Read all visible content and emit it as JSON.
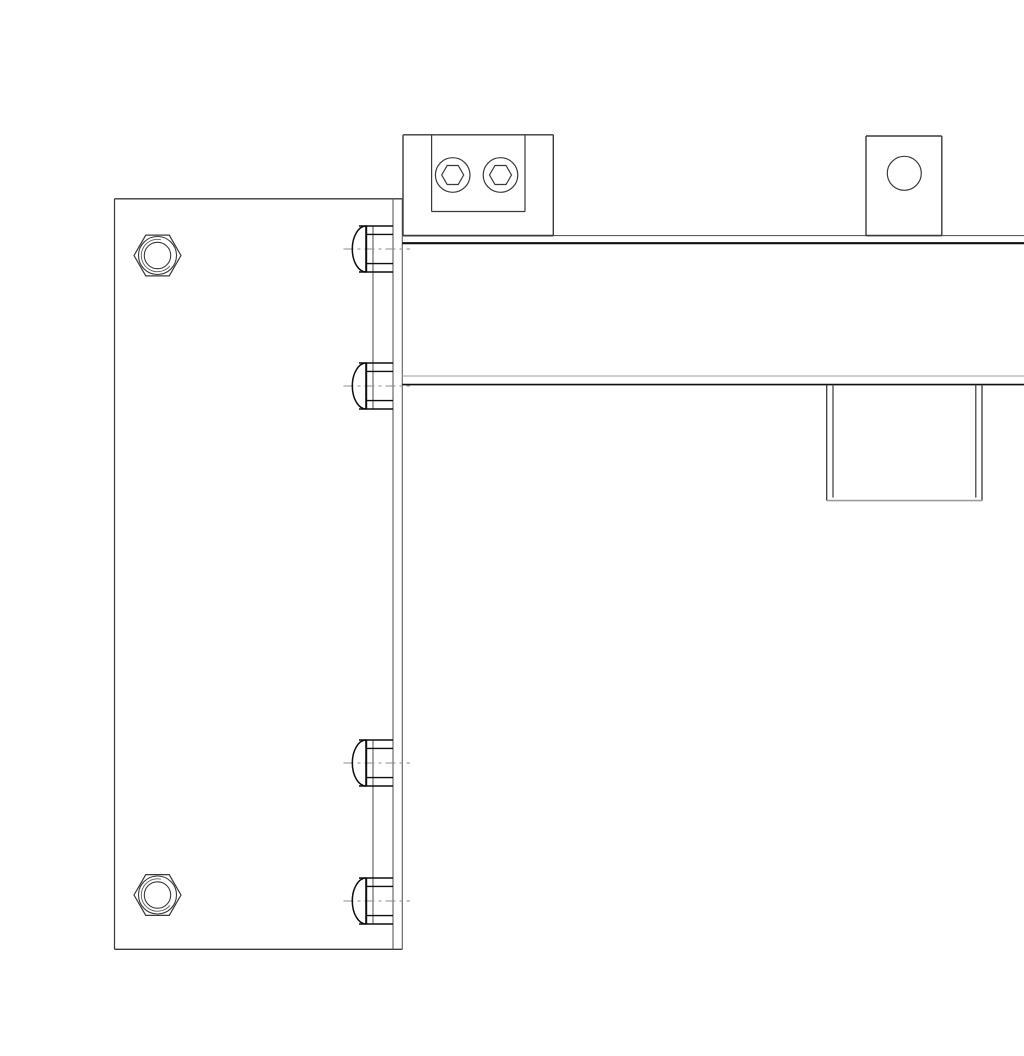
{
  "drawing": {
    "kind": "technical-line-drawing",
    "view": "orthographic-side-view",
    "subject": "L-shaped bracket assembly: tall mounting plate with two hex nuts and two pairs of button-head fasteners, horizontal box beam carrying a clamp bracket with two nut holes, a lifting tab with a round hole, and a hanging end block",
    "background": "#ffffff",
    "canvas": {
      "width": 1024,
      "height": 1024
    },
    "colors": {
      "outline": "#3a3a3a",
      "bold": "#0e0e0e",
      "medium": "#5c5c5c",
      "light": "#9c9c9c",
      "centerline": "#8d8d8d"
    },
    "centerline_dash": "10 4 3 4",
    "plate": {
      "x1": 74.5,
      "y1": 182.8,
      "x2": 353,
      "y2": 933.3,
      "back_edge_x": 362.3
    },
    "plate_nuts": {
      "centers": [
        [
          117.5,
          239.5
        ],
        [
          117.5,
          879
        ]
      ],
      "hex_r": 23.5,
      "face_r": 19,
      "bore_r": 13.2,
      "thread_r": 16.2,
      "thread_gap_start_deg": 40,
      "thread_gap_end_deg": -78
    },
    "bolts": {
      "pairs": [
        [
          233,
          370
        ],
        [
          747,
          885
        ]
      ],
      "apex_x": 312.3,
      "flat_x": 326.2,
      "head_half_h": 23,
      "edge_x1": 319,
      "collar_x": 333,
      "shank_x2": 353,
      "shank_half_h": 14.6,
      "centerline_x1": 303.5,
      "centerline_x2": 370
    },
    "beam": {
      "x1": 362.3,
      "x2": 989,
      "top_outer_y": 219.6,
      "top_inner_y": 227.2,
      "bottom_inner_y": 360,
      "bottom_outer_y": 368.6,
      "right_inner_x": 985,
      "right_outer_x": 989
    },
    "bracket": {
      "outer": [
        363,
        118.8,
        513.3,
        219.6
      ],
      "inner": [
        391.6,
        118.8,
        485,
        195.5
      ],
      "holes": {
        "centers": [
          [
            412.7,
            159
          ],
          [
            460.5,
            159
          ]
        ],
        "face_r": 17.3,
        "hex_r": 11
      }
    },
    "tab": {
      "rect": [
        826,
        120,
        901.8,
        219.6
      ],
      "hole": {
        "center": [
          864.3,
          157.3
        ],
        "r": 17
      }
    },
    "end_block": {
      "y1": 368.6,
      "y2": 484.6,
      "outer_x": [
        786.7,
        942
      ],
      "inner_x": [
        793,
        935.8
      ]
    }
  }
}
